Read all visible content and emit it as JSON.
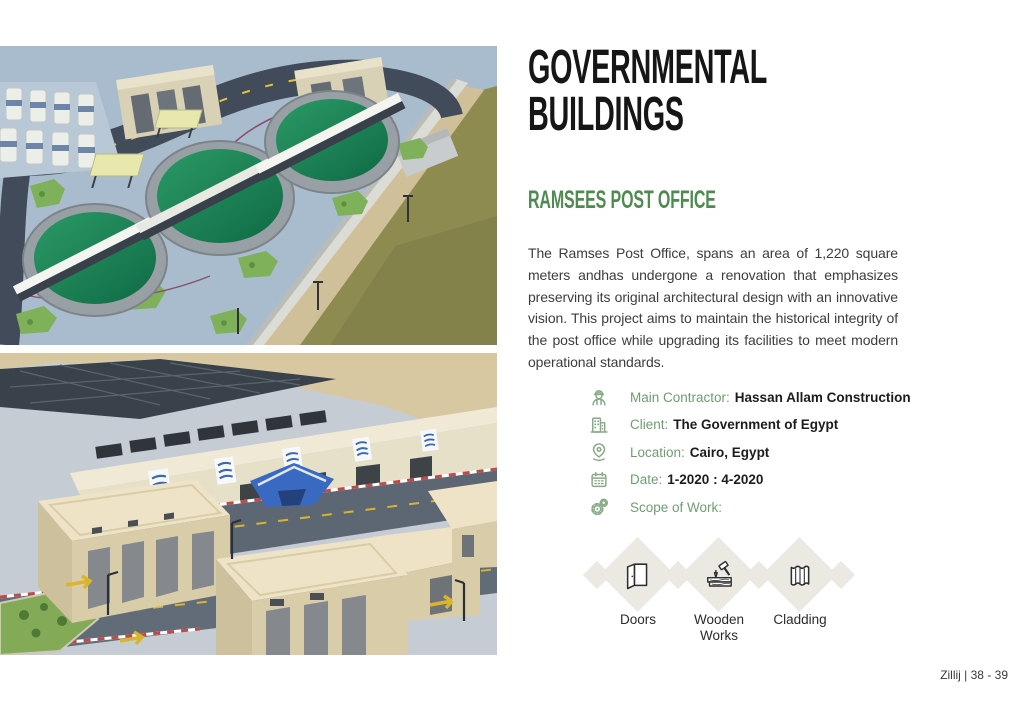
{
  "colors": {
    "accent_green": "#4e8b50",
    "label_green": "#6f9e71",
    "icon_green": "#86ab86",
    "title_black": "#161616",
    "diamond_fill": "#ece9e3",
    "body_text": "#3d3d3d"
  },
  "header": {
    "title_line1": "GOVERNMENTAL",
    "title_line2": "BUILDINGS"
  },
  "project": {
    "name": "RAMSEES POST OFFICE",
    "description": "The Ramses Post Office, spans an area of 1,220 square meters andhas undergone a renovation that emphasizes preserving its original architectural design with an innovative vision. This project aims to maintain the historical integrity of the post office while upgrading its facilities to meet modern operational standards.",
    "details": [
      {
        "icon": "worker-helmet-icon",
        "label": "Main Contractor:",
        "value": "Hassan Allam Construction"
      },
      {
        "icon": "building-icon",
        "label": "Client:",
        "value": "The Government of Egypt"
      },
      {
        "icon": "location-pin-icon",
        "label": "Location:",
        "value": "Cairo, Egypt"
      },
      {
        "icon": "calendar-icon",
        "label": "Date:",
        "value": "1-2020 : 4-2020"
      },
      {
        "icon": "gears-icon",
        "label": "Scope of Work:",
        "value": ""
      }
    ],
    "scope_of_work": [
      {
        "icon": "door-icon",
        "label": "Doors"
      },
      {
        "icon": "hammer-wood-icon",
        "label": "Wooden Works"
      },
      {
        "icon": "cladding-panel-icon",
        "label": "Cladding"
      }
    ]
  },
  "photos": [
    {
      "name": "water-treatment-plant-aerial"
    },
    {
      "name": "governmental-buildings-aerial"
    }
  ],
  "footer": {
    "text": "Zillij | 38 - 39"
  }
}
